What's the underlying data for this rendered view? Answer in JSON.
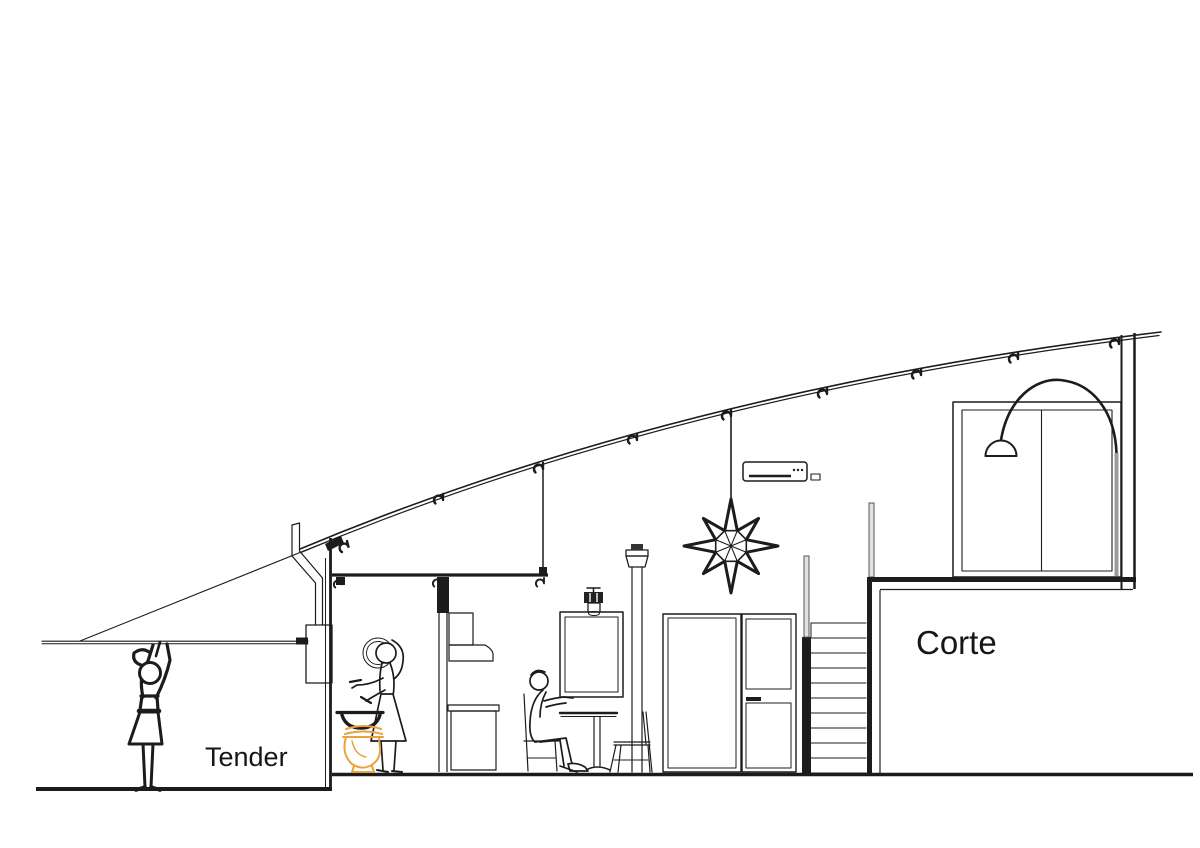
{
  "labels": {
    "tender": "Tender",
    "corte": "Corte"
  },
  "colors": {
    "line": "#1c1c1c",
    "accent_orange": "#e9a23f",
    "metal_gray": "#9b9b9b",
    "background": "#ffffff"
  }
}
